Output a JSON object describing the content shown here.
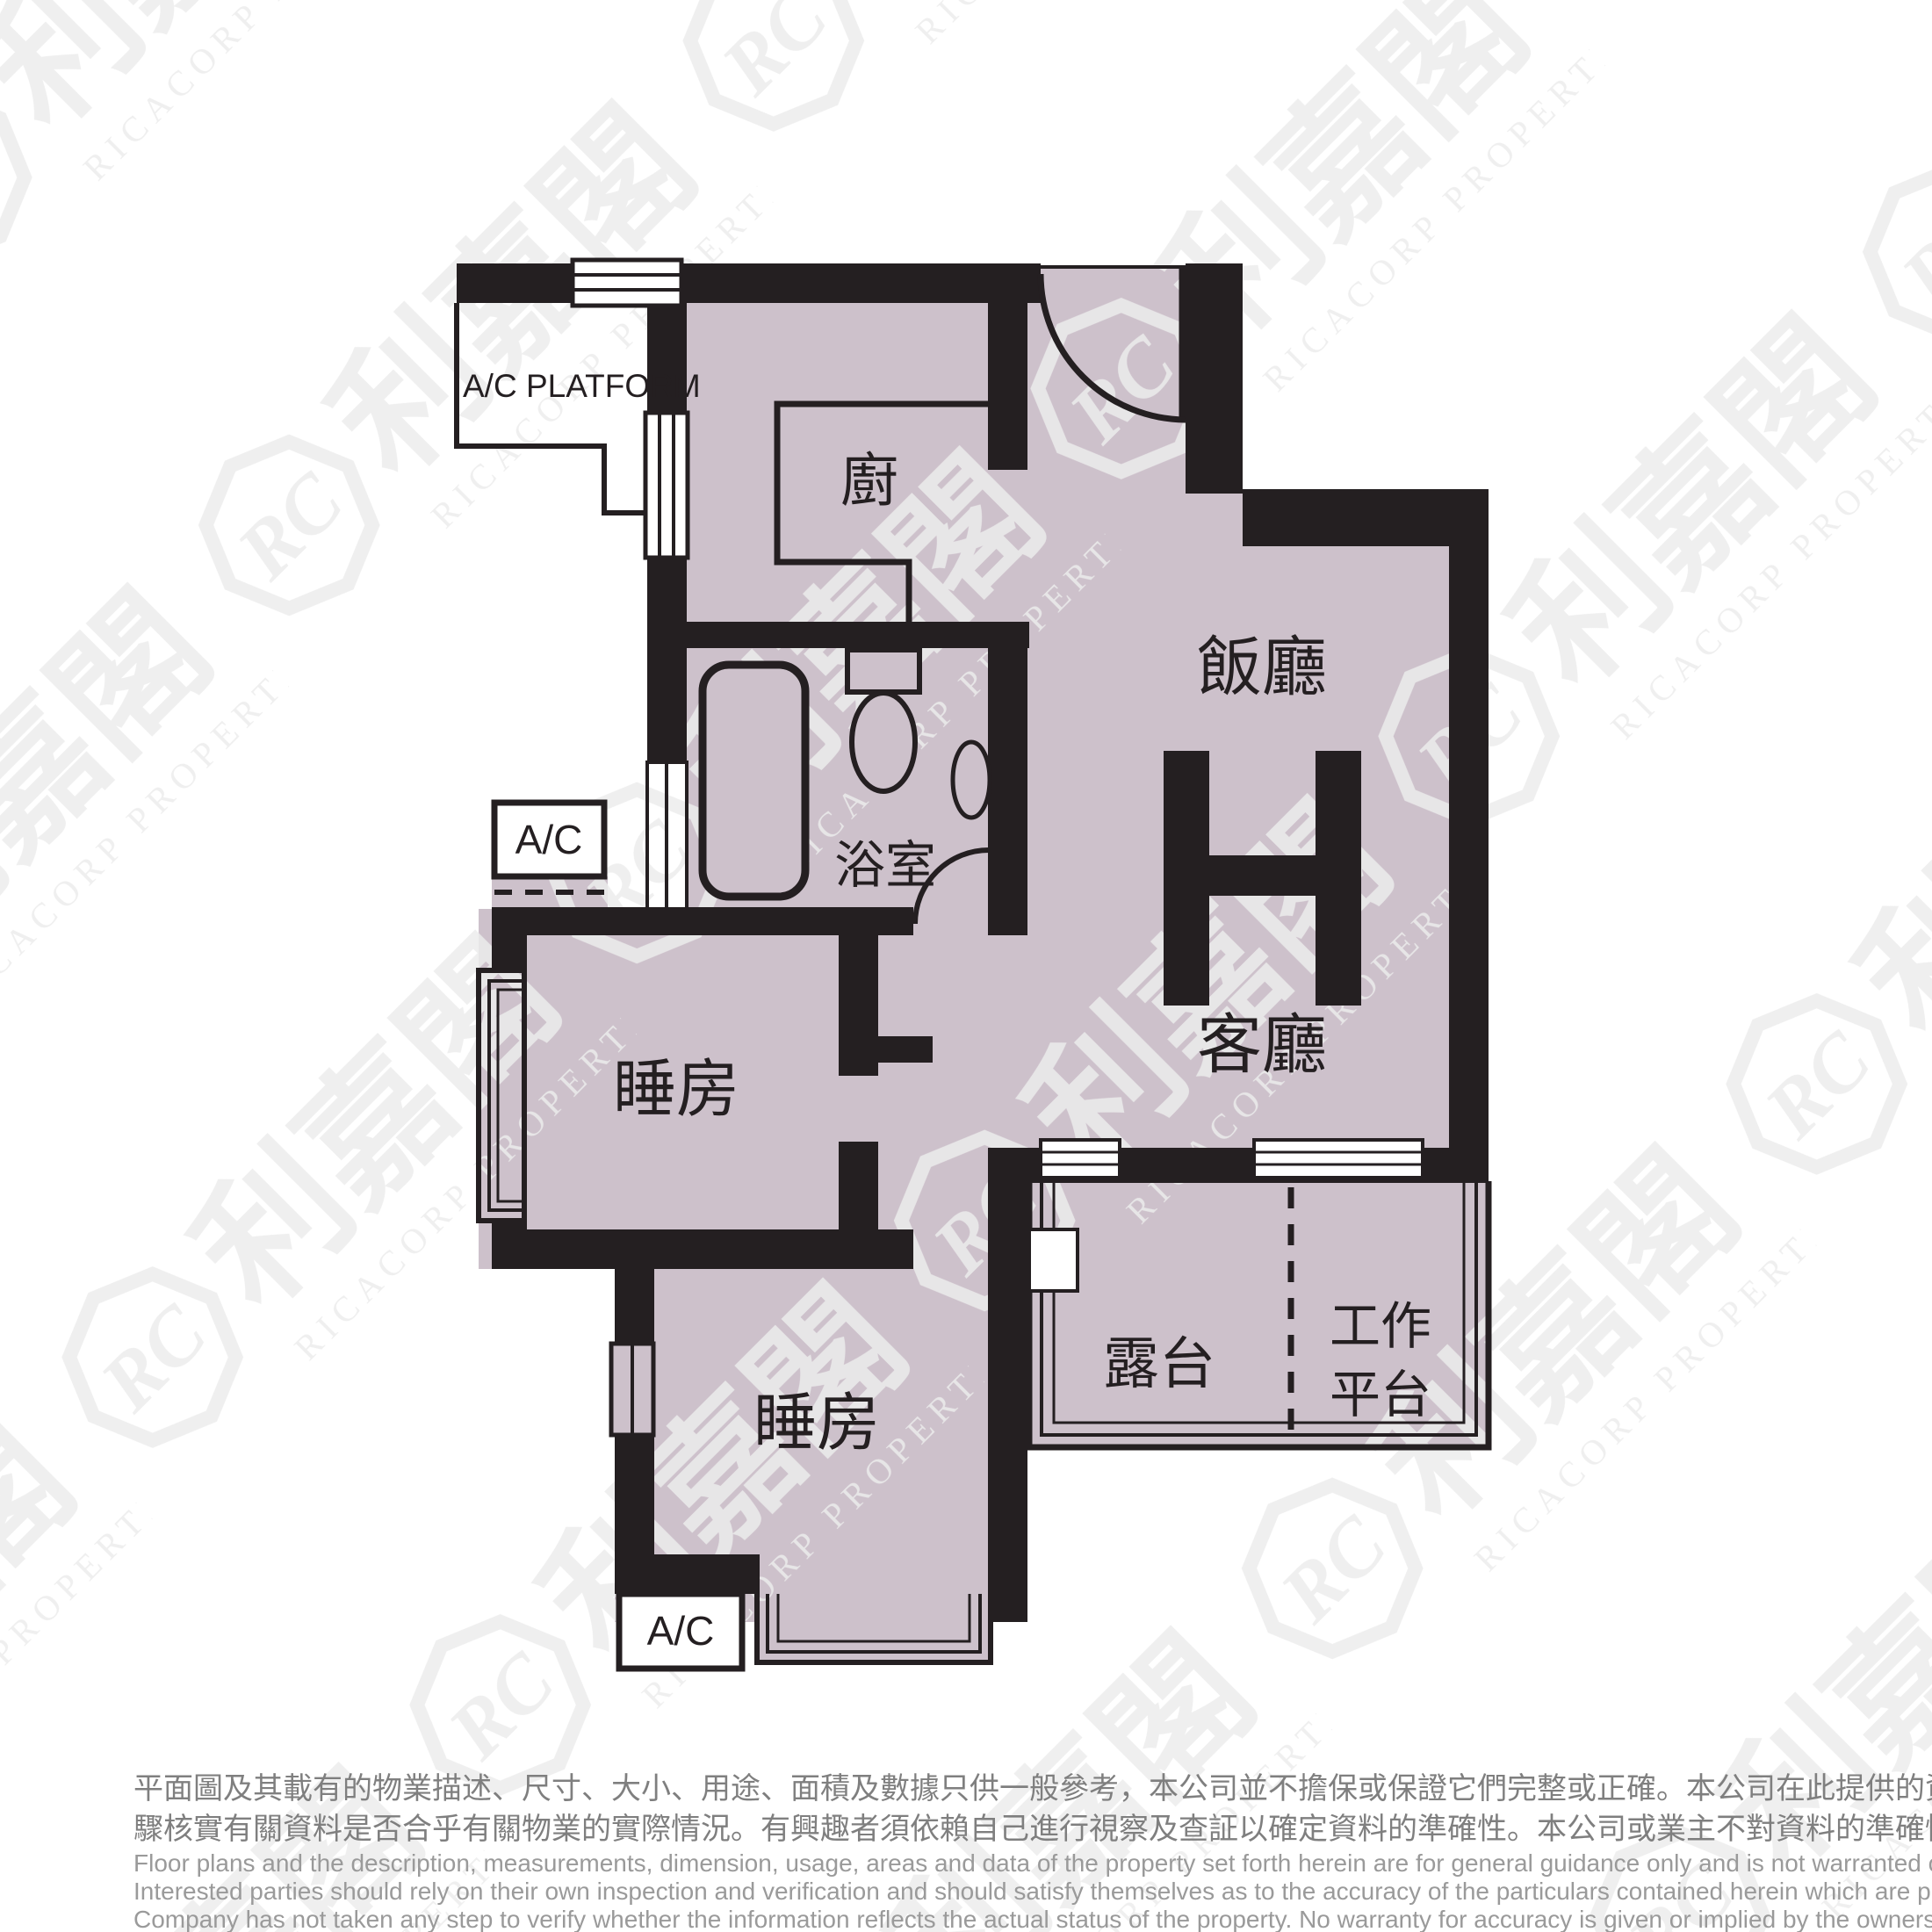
{
  "colors": {
    "wall": "#241f21",
    "floor": "#cdc1cb",
    "watermark": "#ececec",
    "disclaimer_chinese": "#7f7f7f",
    "disclaimer_english": "#9a9a9a",
    "background": "#ffffff"
  },
  "plan": {
    "unit_letter": "H",
    "rooms": {
      "kitchen": "廚",
      "bathroom": "浴室",
      "dining": "飯廳",
      "living": "客廳",
      "bedroom1": "睡房",
      "bedroom2": "睡房",
      "balcony": "露台",
      "utility_line1": "工作",
      "utility_line2": "平台"
    },
    "annotations": {
      "ac_platform": "A/C PLATFORM",
      "ac_mid": "A/C",
      "ac_bottom": "A/C"
    }
  },
  "watermark": {
    "logo_initials": "RC",
    "brand_cn": "利嘉閣",
    "brand_en": "RICACORP PROPERTIES"
  },
  "disclaimer": {
    "cn_line1": "平面圖及其載有的物業描述、尺寸、大小、用途、面積及數據只供一般參考，本公司並不擔保或保證它們完整或正確。本公司在此提供的資料只供閣下參考，本公司並無採取任何步",
    "cn_line2": "驟核實有關資料是否合乎有關物業的實際情況。有興趣者須依賴自己進行視察及查証以確定資料的準確性。本公司或業主不對資料的準確性作出任何明示或隱含的保證。",
    "en_line1": "Floor plans and the description, measurements, dimension, usage, areas and data of the property set forth herein are for general guidance only and is not warranted or guaranteed to be complete or correct.",
    "en_line2": "Interested parties should rely on their own inspection and verification and should satisfy themselves as to the accuracy of the particulars contained herein which are provided by us for information only.  Our",
    "en_line3": "Company has not taken any step to verify whether the information reflects the actual status of the property.  No warranty for accuracy is given or implied by the owners or us."
  }
}
